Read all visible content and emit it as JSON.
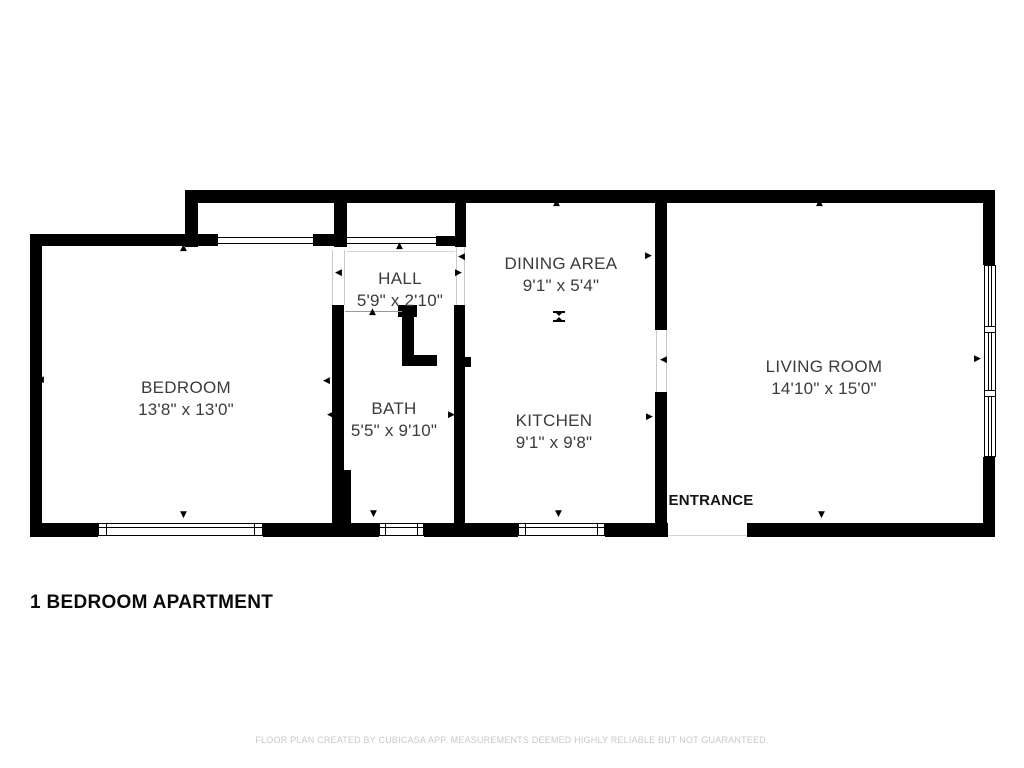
{
  "title": "1 BEDROOM APARTMENT",
  "disclaimer": "FLOOR PLAN CREATED BY CUBICASA APP. MEASUREMENTS DEEMED HIGHLY RELIABLE BUT NOT GUARANTEED.",
  "entrance": {
    "label": "ENTRANCE"
  },
  "rooms": [
    {
      "id": "bedroom",
      "name": "BEDROOM",
      "dims": "13'8\" x 13'0\""
    },
    {
      "id": "hall",
      "name": "HALL",
      "dims": "5'9\" x 2'10\""
    },
    {
      "id": "bath",
      "name": "BATH",
      "dims": "5'5\" x 9'10\""
    },
    {
      "id": "dining-area",
      "name": "DINING AREA",
      "dims": "9'1\" x 5'4\""
    },
    {
      "id": "kitchen",
      "name": "KITCHEN",
      "dims": "9'1\" x 9'8\""
    },
    {
      "id": "living-room",
      "name": "LIVING ROOM",
      "dims": "14'10\" x 15'0\""
    }
  ],
  "icons": {
    "arrow_up": "▲",
    "arrow_down": "▼",
    "arrow_left": "◀",
    "arrow_right": "▶"
  },
  "colors": {
    "wall": "#000000",
    "room_label": "#3b3b3b",
    "title": "#0a0a0a",
    "disclaimer": "#c8c8c8",
    "background": "#ffffff"
  }
}
